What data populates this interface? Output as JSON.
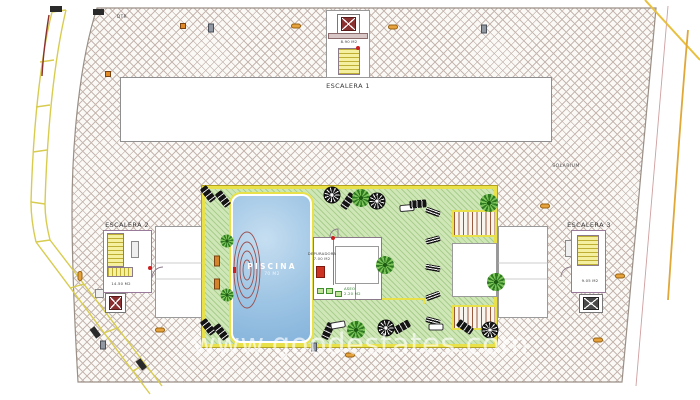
{
  "labels": {
    "escalera1": "ESCALERA 1",
    "escalera2": "ESCALERA 2",
    "escalera3": "ESCALERA 3",
    "solarium": "SOLARIUM",
    "deck_note": "DTR",
    "piscina": {
      "title": "PISCINA",
      "area": "70 M2"
    },
    "depuradora": {
      "title": "DEPURADORA",
      "area": "7.00 M2"
    },
    "aseo": {
      "title": "ASEO",
      "area": "2.20 M2"
    },
    "stair1_area": "8.90 M2",
    "stair2_area": "14.50 M2",
    "stair3_area": "9.05 M2"
  },
  "watermark": "www.goodestates.com",
  "colors": {
    "deck_line": "#9a8f86",
    "terrace_green": "#cfe7b6",
    "border_yellow": "#e8e14a",
    "pool_blue": "#8fb9de",
    "stair_yellow": "#f4f0a0",
    "lift_maroon": "#8a3030",
    "marker_orange": "#e08a28",
    "facade_yellow": "#d8cc50"
  },
  "decorations": [
    {
      "type": "lounger-dark",
      "x": 208,
      "y": 194,
      "rot": -38
    },
    {
      "type": "lounger-dark",
      "x": 223,
      "y": 199,
      "rot": -38
    },
    {
      "type": "parasol",
      "x": 332,
      "y": 195,
      "rot": 0
    },
    {
      "type": "lounger-dark",
      "x": 348,
      "y": 201,
      "rot": 35
    },
    {
      "type": "palm",
      "x": 361,
      "y": 198,
      "rot": 10
    },
    {
      "type": "parasol",
      "x": 377,
      "y": 201,
      "rot": 15
    },
    {
      "type": "lounger-white",
      "x": 407,
      "y": 208,
      "rot": 85
    },
    {
      "type": "lounger-dark",
      "x": 418,
      "y": 204,
      "rot": 85
    },
    {
      "type": "palm",
      "x": 489,
      "y": 203,
      "rot": 0
    },
    {
      "type": "plant",
      "x": 227,
      "y": 241,
      "rot": 0
    },
    {
      "type": "plant",
      "x": 227,
      "y": 295,
      "rot": 20
    },
    {
      "type": "bench-orange",
      "x": 217,
      "y": 261,
      "rot": 0
    },
    {
      "type": "bench-orange",
      "x": 217,
      "y": 284,
      "rot": 0
    },
    {
      "type": "palm",
      "x": 385,
      "y": 265,
      "rot": 30
    },
    {
      "type": "palm",
      "x": 496,
      "y": 282,
      "rot": 0
    },
    {
      "type": "table-set",
      "x": 433,
      "y": 212,
      "rot": 20
    },
    {
      "type": "table-set",
      "x": 433,
      "y": 240,
      "rot": -15
    },
    {
      "type": "table-set",
      "x": 433,
      "y": 268,
      "rot": 10
    },
    {
      "type": "table-set",
      "x": 433,
      "y": 296,
      "rot": -20
    },
    {
      "type": "table-set",
      "x": 433,
      "y": 321,
      "rot": 15
    },
    {
      "type": "lounger-dark",
      "x": 208,
      "y": 327,
      "rot": -38
    },
    {
      "type": "lounger-dark",
      "x": 221,
      "y": 332,
      "rot": -38
    },
    {
      "type": "lounger-dark",
      "x": 328,
      "y": 331,
      "rot": 25
    },
    {
      "type": "lounger-white",
      "x": 338,
      "y": 325,
      "rot": 80
    },
    {
      "type": "palm",
      "x": 356,
      "y": 330,
      "rot": 0
    },
    {
      "type": "parasol",
      "x": 386,
      "y": 328,
      "rot": 0
    },
    {
      "type": "lounger-dark",
      "x": 402,
      "y": 327,
      "rot": 60
    },
    {
      "type": "lounger-white",
      "x": 436,
      "y": 327,
      "rot": 90
    },
    {
      "type": "lounger-dark",
      "x": 465,
      "y": 327,
      "rot": -55
    },
    {
      "type": "parasol",
      "x": 490,
      "y": 330,
      "rot": 10
    }
  ],
  "markers": [
    {
      "type": "orange-square",
      "x": 183,
      "y": 26,
      "rot": 0
    },
    {
      "type": "gray-rect",
      "x": 211,
      "y": 28,
      "rot": 0
    },
    {
      "type": "orange-oval",
      "x": 296,
      "y": 26,
      "rot": 0
    },
    {
      "type": "orange-oval",
      "x": 393,
      "y": 27,
      "rot": 0
    },
    {
      "type": "gray-rect",
      "x": 484,
      "y": 29,
      "rot": 0
    },
    {
      "type": "orange-square",
      "x": 108,
      "y": 74,
      "rot": 0
    },
    {
      "type": "orange-oval",
      "x": 80,
      "y": 276,
      "rot": 90
    },
    {
      "type": "orange-oval",
      "x": 160,
      "y": 330,
      "rot": 0
    },
    {
      "type": "gray-rect",
      "x": 103,
      "y": 345,
      "rot": 0
    },
    {
      "type": "gray-rect",
      "x": 314,
      "y": 347,
      "rot": 0
    },
    {
      "type": "orange-oval",
      "x": 350,
      "y": 355,
      "rot": 0
    },
    {
      "type": "orange-oval",
      "x": 545,
      "y": 206,
      "rot": 0
    },
    {
      "type": "orange-oval",
      "x": 620,
      "y": 276,
      "rot": 0
    },
    {
      "type": "orange-oval",
      "x": 598,
      "y": 340,
      "rot": 0
    },
    {
      "type": "red-dot",
      "x": 358,
      "y": 48,
      "rot": 0
    },
    {
      "type": "red-dot",
      "x": 333,
      "y": 238,
      "rot": 0
    },
    {
      "type": "red-dot",
      "x": 150,
      "y": 268,
      "rot": 0
    }
  ]
}
